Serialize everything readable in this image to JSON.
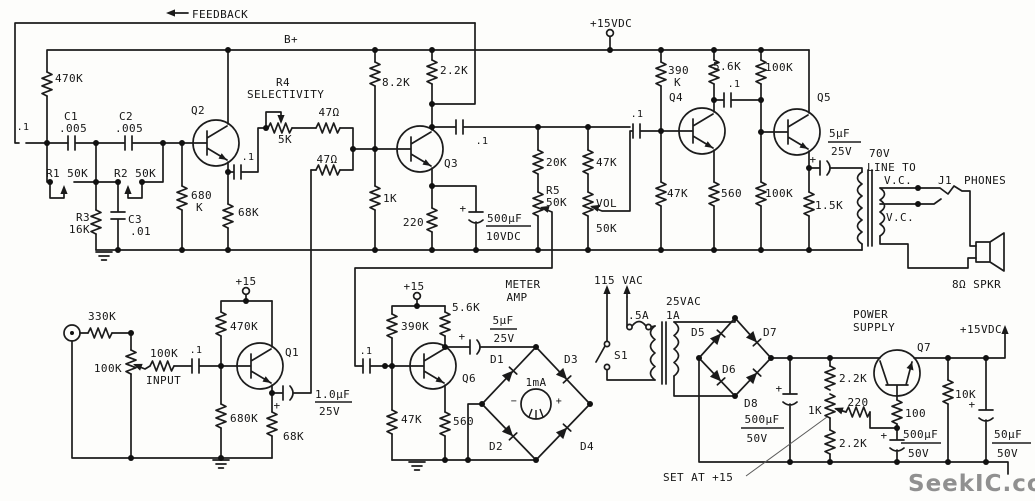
{
  "header": {
    "feedback": "FEEDBACK",
    "b_plus": "B+",
    "vdc15": "+15VDC",
    "plus15": "+15"
  },
  "common": {
    "p1": ".1",
    "p005": ".005",
    "plus": "+",
    "minus": "−",
    "ohm47": "47Ω",
    "k47": "47K",
    "k100": "100K",
    "k50": "50K",
    "k2_2": "2.2K",
    "k5_6": "5.6K",
    "r560": "560",
    "k1": "1K",
    "k220": "220",
    "k68": "68K",
    "k470": "470K",
    "k390": "390K",
    "uF500": "500μF",
    "uF5": "5μF",
    "uF50": "50μF",
    "uF1": "1.0μF",
    "v25": "25V",
    "v50": "50V",
    "v10": "10VDC",
    "vc": "V.C."
  },
  "tone": {
    "c1": "C1",
    "c2": "C2",
    "c3": "C3",
    "c01": ".01",
    "r1": "R1 50K",
    "r2": "R2 50K",
    "r3": "R3",
    "k16": "16K",
    "q2": "Q2",
    "r680": "680",
    "kunit": "K"
  },
  "sel": {
    "r4": "R4",
    "name": "SELECTIVITY",
    "k5": "5K"
  },
  "mid": {
    "q3": "Q3",
    "k8_2": "8.2K",
    "k20": "20K",
    "r5": "R5",
    "vol": "VOL"
  },
  "amp": {
    "q4": "Q4",
    "q5": "Q5",
    "r390": "390",
    "k1_5": "1.5K"
  },
  "out": {
    "v70": "70V",
    "line_to": "LINE TO",
    "j1": "J1",
    "phones": "PHONES",
    "spkr": "8Ω SPKR"
  },
  "pre": {
    "q1": "Q1",
    "k330": "330K",
    "input": "INPUT",
    "k680": "680K"
  },
  "meter": {
    "t1": "METER",
    "t2": "AMP",
    "q6": "Q6",
    "ma": "1mA",
    "d1": "D1",
    "d2": "D2",
    "d3": "D3",
    "d4": "D4"
  },
  "psu": {
    "vac115": "115 VAC",
    "fuse": ".5A",
    "s1": "S1",
    "vac25": "25VAC",
    "a1": "1A",
    "d5": "D5",
    "d6": "D6",
    "d7": "D7",
    "d8": "D8",
    "set": "SET AT +15",
    "t1": "POWER",
    "t2": "SUPPLY",
    "q7": "Q7",
    "r100": "100",
    "k10": "10K",
    "out": "+15VDC"
  },
  "watermark": "SeekIC.com"
}
